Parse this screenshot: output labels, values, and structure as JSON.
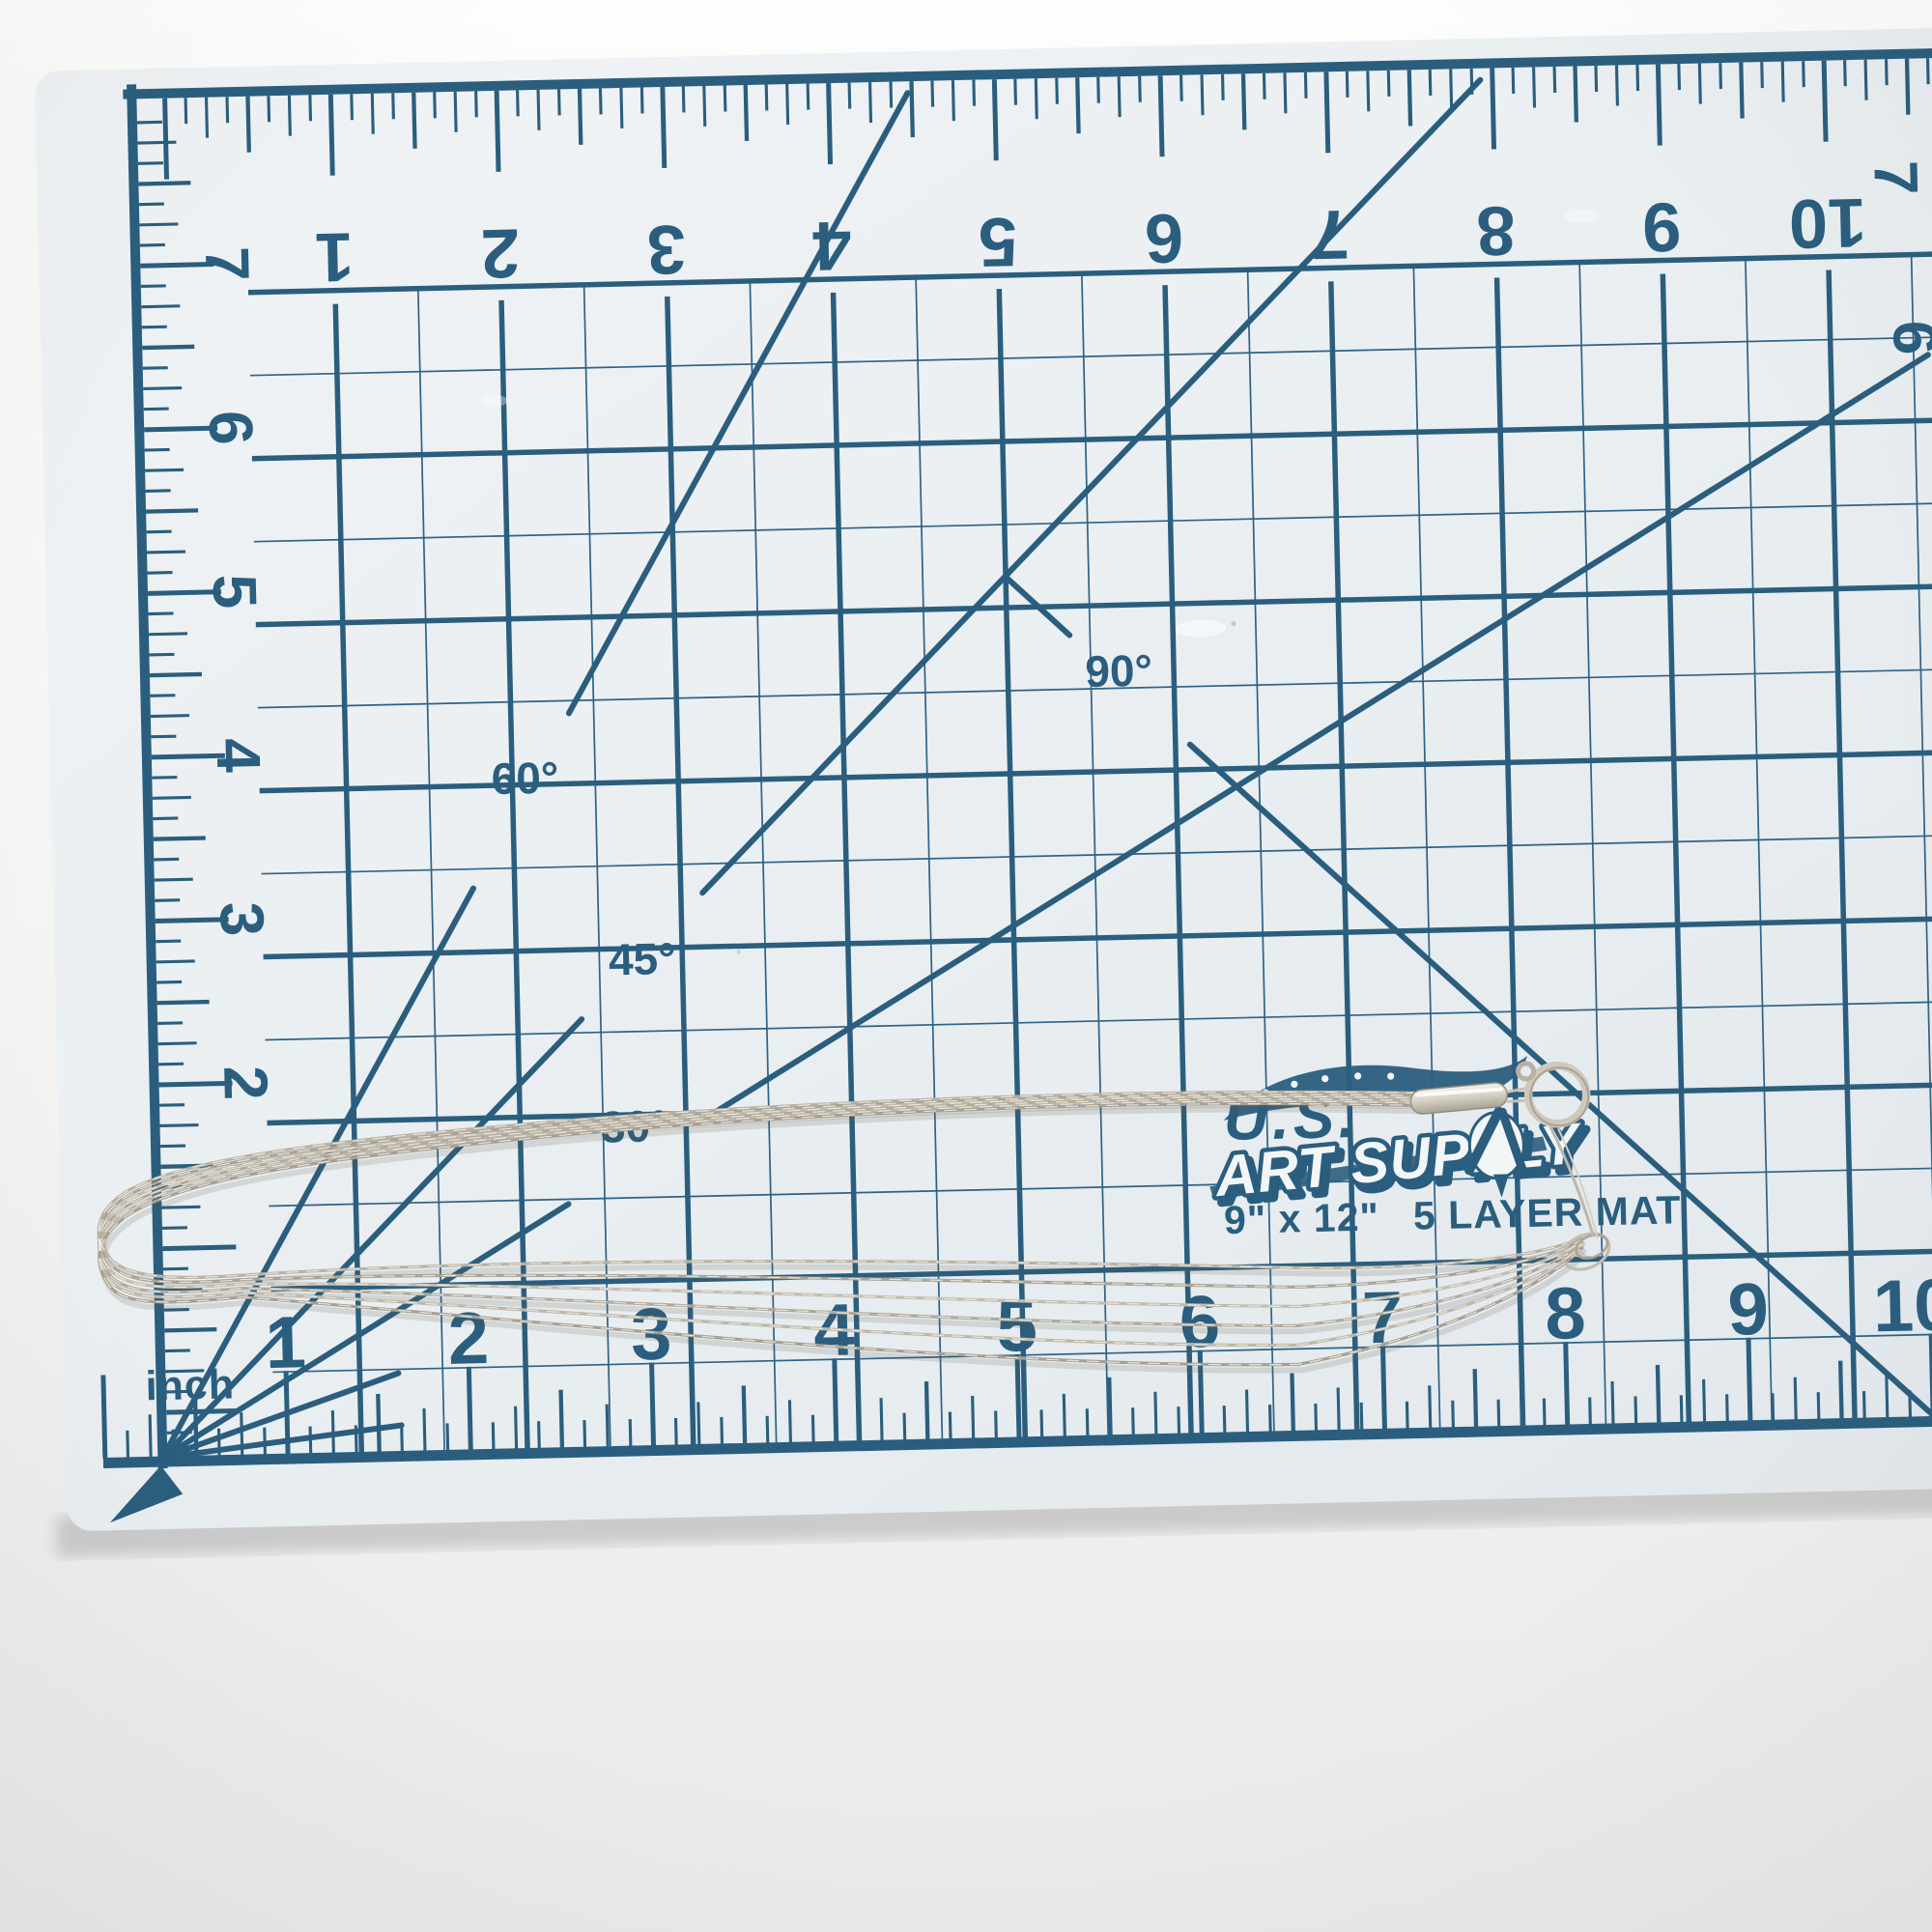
{
  "mat": {
    "logo": {
      "brand_prefix": "U.S.",
      "brand_name": "ART SUPPLY",
      "size_label": "9\" x 12\"",
      "type_label": "5 LAYER MAT"
    },
    "unit_label": "inch",
    "angle_labels": {
      "a30": "30°",
      "a45": "45°",
      "a60": "60°",
      "a90": "90°"
    },
    "rulers": {
      "top": [
        "1",
        "2",
        "3",
        "4",
        "5",
        "6",
        "7",
        "8",
        "9",
        "10"
      ],
      "bottom": [
        "1",
        "2",
        "3",
        "4",
        "5",
        "6",
        "7",
        "8",
        "9",
        "10"
      ],
      "left": [
        "7",
        "6",
        "5",
        "4",
        "3",
        "2"
      ],
      "right": [
        "7",
        "6"
      ]
    },
    "colors": {
      "print": "#2b5e7e",
      "thin_line": "#2f6286",
      "surface": "#e9eef1",
      "edge": "#f6f7f6"
    }
  },
  "background": {
    "color_top": "#fbfbf9",
    "color_bottom": "#eaeae8"
  },
  "necklace": {
    "visible_strands": 5,
    "color": "#beb7aa",
    "clasp": "spring-ring"
  }
}
